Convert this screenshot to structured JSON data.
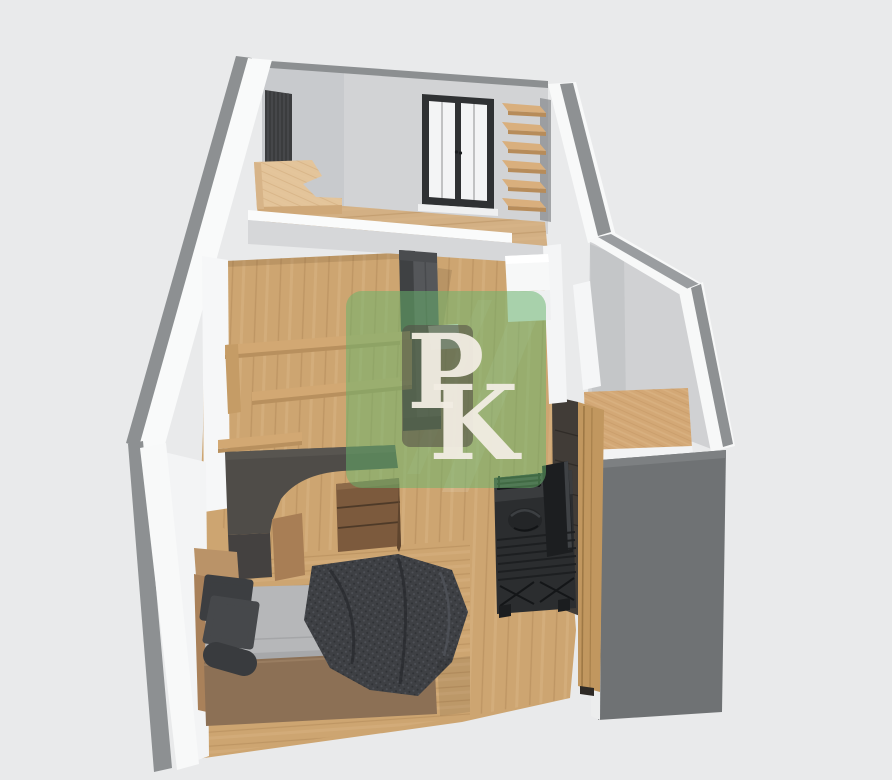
{
  "scene": {
    "background": "#e9eaeb",
    "description": "3D isometric cutaway render of a narrow studio apartment floor plan"
  },
  "watermark": {
    "letters": {
      "p": "P",
      "k": "K"
    },
    "green_color": "#68b56c",
    "panel_color": "#554f47",
    "letter_color": "#f2ede3"
  },
  "palette": {
    "wall_white": "#f8f9f9",
    "wall_top_gray": "#8d9092",
    "wall_shadow_face": "#d2d3d5",
    "floor_wood": "#cda571",
    "shelf_wood": "#d9af7d",
    "drawer_wood": "#7c5a3d",
    "desk_dark": "#4f4c48",
    "mattress_gray": "#b6b7b9",
    "fabric_dark": "#3e4044",
    "console_black": "#2b2d2f",
    "side_panel_gray": "#6f7274",
    "window_frame": "#2f3133"
  },
  "inventory": {
    "corner_shelf_boards": 6,
    "desk_drawers": 3,
    "window_panes": 2,
    "bed_pillows": 3
  }
}
